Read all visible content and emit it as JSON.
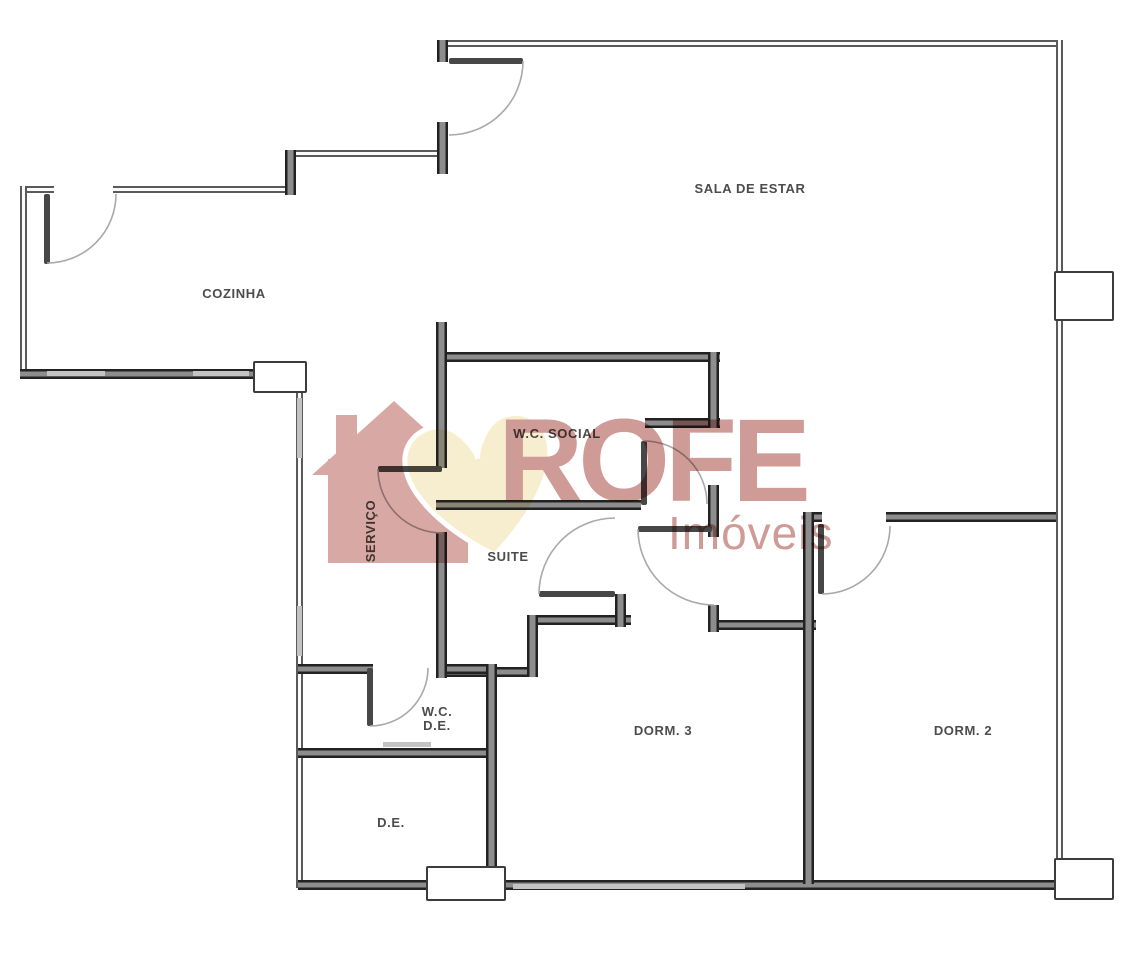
{
  "watermark": {
    "brand": "ROFE",
    "tagline": "Imóveis",
    "brand_color": "#c98d88",
    "house_color": "#d29c98",
    "heart_color": "#f6ecca"
  },
  "rooms": {
    "sala": {
      "label": "SALA DE ESTAR"
    },
    "cozinha": {
      "label": "COZINHA"
    },
    "wc_social": {
      "label": "W.C. SOCIAL"
    },
    "servico": {
      "label": "SERVIÇO"
    },
    "suite": {
      "label": "SUITE"
    },
    "wc_de": {
      "line1": "W.C.",
      "line2": "D.E."
    },
    "dorm3": {
      "label": "DORM. 3"
    },
    "dorm2": {
      "label": "DORM. 2"
    },
    "de": {
      "label": "D.E."
    }
  },
  "colors": {
    "wall_dark": "#222222",
    "wall_core": "#8d8d8d",
    "window": "#c3c3c3",
    "label": "#4c4c4c"
  }
}
